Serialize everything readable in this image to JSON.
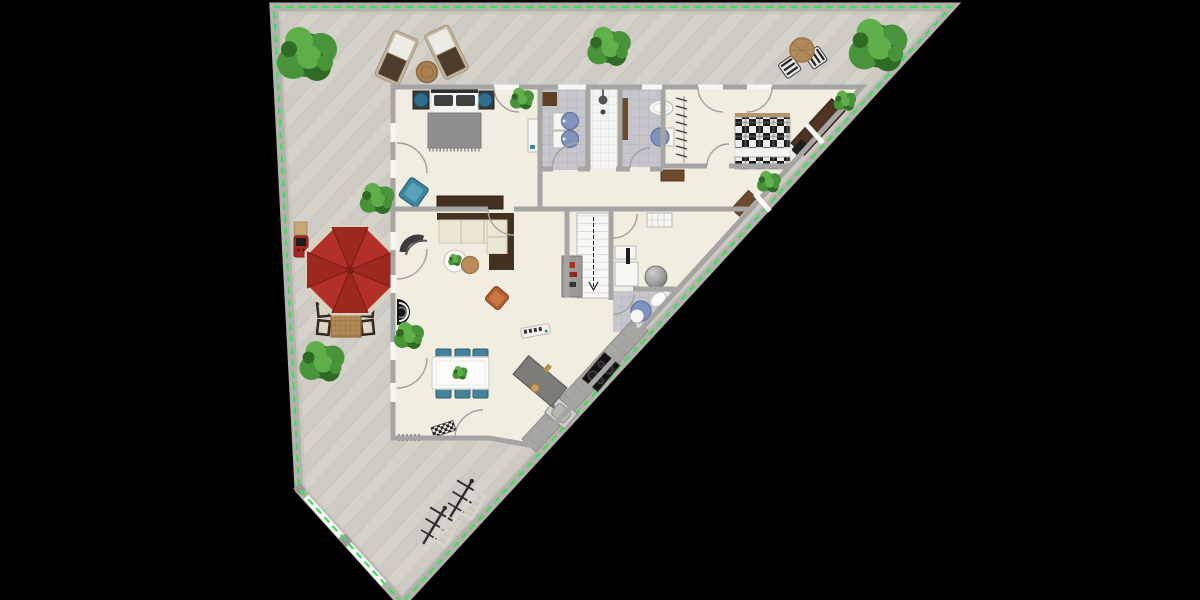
{
  "scene": {
    "type": "2d-floor-plan-render",
    "view": "top-down",
    "canvas": {
      "width": 1200,
      "height": 600,
      "background": "#000000"
    },
    "selection": "lot boundary highlighted with bright green dashed outline"
  },
  "colors": {
    "deck": "#d3d1c9",
    "deck_dark": "#cac8c0",
    "deck_line": "#bdbbb3",
    "fence": "#b4b2ac",
    "gate_white": "#f6f6f4",
    "lot_outline": "#3ede5b",
    "floor": "#f1ede0",
    "wall": "#a5a5a3",
    "tile": "#c6c6cc",
    "tile_line": "#b2b2ba",
    "shower": "#f3f3f1",
    "shower_line": "#dededa",
    "water_blue": "#8093bd",
    "water_dark": "#5f739f",
    "teal": "#3d87a0",
    "teal_dark": "#2a6478",
    "petrol_chair": "#47829b",
    "cushion": "#ece6d4",
    "wood_dark": "#43321f",
    "wood_mid": "#6b4a2e",
    "wood_warm": "#b08955",
    "wood_light": "#c8a671",
    "walnut": "#4e3423",
    "rug_gray": "#8f8f8f",
    "pillow": "#3f3f3f",
    "plaid_dark": "#1a1a1a",
    "plaid_light": "#ececea",
    "white_item": "#f6f6f3",
    "umbrella_red": "#b23027",
    "umbrella_dark": "#9c2820",
    "umbrella_line": "#7c1d16",
    "umbrella_trim": "#d8d1c0",
    "grill_red": "#a8291f",
    "orange_chair": "#b5602f",
    "counter": "#a6a6a3",
    "counter_line": "#8e8e8b",
    "island": "#7c7c79",
    "stairs": "#f7f7f5",
    "tread": "#c9c9c5",
    "ball_gray": "#9a9a9a",
    "plant_dark": "#2f6b25",
    "plant_mid": "#49943a",
    "plant_light": "#5fb04a",
    "black_item": "#1b1b1b"
  },
  "lot": {
    "name": "triangular-corner-lot",
    "surface": "diagonal wood deck planks",
    "fence": "gray perimeter fence",
    "gates": [
      "white-gate-upper-southwest",
      "white-gate-lower-southwest"
    ]
  },
  "rooms": [
    {
      "name": "master-bedroom",
      "floor": "cream"
    },
    {
      "name": "bathroom-1",
      "floor": "gray-tile"
    },
    {
      "name": "shower-room",
      "floor": "white-tile"
    },
    {
      "name": "bathroom-2",
      "floor": "gray-tile"
    },
    {
      "name": "bedroom-2",
      "floor": "cream"
    },
    {
      "name": "hallway",
      "floor": "cream"
    },
    {
      "name": "stair-hall",
      "floor": "cream"
    },
    {
      "name": "office",
      "floor": "cream"
    },
    {
      "name": "bathroom-3",
      "floor": "gray-tile"
    },
    {
      "name": "living-room",
      "floor": "cream"
    },
    {
      "name": "dining-area",
      "floor": "cream"
    },
    {
      "name": "kitchen",
      "floor": "cream"
    }
  ],
  "furniture": {
    "master_bedroom": [
      "double-bed gray blanket",
      "nightstand x2 with teal lamps",
      "teal armchair",
      "dark walnut dresser",
      "white dressing table",
      "potted plant"
    ],
    "bathroom_1": [
      "double round blue washbasins on white vanity",
      "brown bath mat"
    ],
    "shower_room": [
      "walk-in shower",
      "shower head",
      "floor drain"
    ],
    "bathroom_2": [
      "white bathtub",
      "round blue washbasin",
      "brown runner rug"
    ],
    "bedroom_2": [
      "double bed black-white plaid",
      "open wardrobe with hangers",
      "walnut desk along diagonal wall",
      "black desk chair",
      "potted plant x2"
    ],
    "hallway": [
      "brown runner rug x2",
      "potted plant"
    ],
    "stair_hall": [
      "staircase with direction arrow",
      "gray shelving unit with red books"
    ],
    "office": [
      "white desk with black monitor",
      "white storage bench",
      "gray ball chair"
    ],
    "bathroom_3": [
      "white toilet",
      "round blue washbasin",
      "bath mat"
    ],
    "living_room": [
      "corner sofa cream cushions walnut frame",
      "round white coffee table with plant",
      "round wood side table",
      "dark curved lounge chair",
      "rust orange armchair",
      "black round stove",
      "white soundbar with black keys",
      "potted plant"
    ],
    "dining_area": [
      "white dining table for six",
      "petrol blue chair x6",
      "centerpiece plant",
      "radiator",
      "checkered entrance doormat"
    ],
    "kitchen": [
      "gray counter along diagonal wall",
      "black cooktop 4 burners",
      "stainless sink",
      "dark gray kitchen island with utensils"
    ]
  },
  "outdoor_items": [
    "sun lounger x2",
    "round wood side table",
    "red octagonal parasol",
    "wicker table with 4 cushioned chairs",
    "red barbecue grill",
    "wood storage box",
    "bistro table with 2 striped chairs",
    "rotary clothesline x2",
    "step ladder x2",
    "tree-top-left",
    "tree-top-center",
    "palm-top-right",
    "bush-left-middle",
    "bush-left-lower"
  ]
}
